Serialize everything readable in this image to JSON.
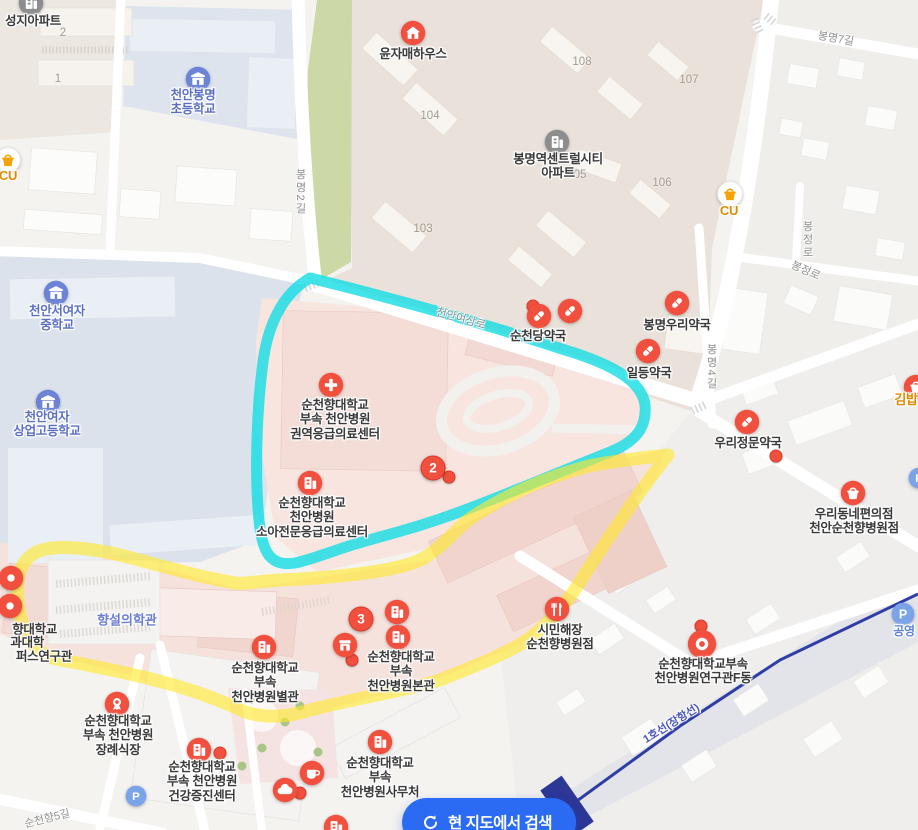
{
  "colors": {
    "poi_red": "#f2503e",
    "poi_red_border": "#d83a27",
    "school_blue": "#6c83d6",
    "apartment_gray": "#8d8d8d",
    "cu_orange": "#f5a300",
    "cu_text": "#e08a00",
    "parking_blue": "#7ba3e8",
    "label_dark": "#3a3a3a",
    "label_school": "#5b6fc4",
    "label_campus": "#6b7ed6",
    "label_road": "#8e8e8e",
    "label_parking": "#5b82d8",
    "railway_text": "#4a55b8",
    "highlight_cyan": "#0ddce4",
    "highlight_yellow": "#ffe92c",
    "button_blue": "#2b6bf3"
  },
  "button": {
    "label": "현 지도에서 검색"
  },
  "road_labels": [
    {
      "text": "봉명2길",
      "x": 300,
      "y": 192,
      "vertical": true
    },
    {
      "text": "봉명7길",
      "x": 836,
      "y": 38,
      "rotate": 10
    },
    {
      "text": "봉명4길",
      "x": 711,
      "y": 367,
      "vertical": true
    },
    {
      "text": "봉정로",
      "x": 807,
      "y": 240,
      "vertical": true
    },
    {
      "text": "봉정로",
      "x": 806,
      "y": 270,
      "rotate": 24
    },
    {
      "text": "천안여상로",
      "x": 461,
      "y": 318,
      "rotate": 16
    },
    {
      "text": "순천향5길",
      "x": 47,
      "y": 818,
      "rotate": -14
    },
    {
      "text": "1호선(장항선)",
      "x": 671,
      "y": 723,
      "rotate": -32,
      "style": "railway"
    }
  ],
  "building_numbers": [
    {
      "text": "2",
      "x": 63,
      "y": 33
    },
    {
      "text": "1",
      "x": 58,
      "y": 79
    },
    {
      "text": "104",
      "x": 430,
      "y": 116
    },
    {
      "text": "103",
      "x": 423,
      "y": 229
    },
    {
      "text": "108",
      "x": 582,
      "y": 62
    },
    {
      "text": "107",
      "x": 689,
      "y": 80
    },
    {
      "text": "106",
      "x": 662,
      "y": 183
    },
    {
      "text": "05",
      "x": 580,
      "y": 175
    }
  ],
  "campus_labels": [
    {
      "text": "향설의학관",
      "x": 127,
      "y": 619
    }
  ],
  "cutoff_labels": [
    {
      "text": "향대학교",
      "x": 57,
      "y": 628
    },
    {
      "text": "과대학",
      "x": 44,
      "y": 641
    },
    {
      "text": "퍼스연구관",
      "x": 72,
      "y": 655
    }
  ],
  "numbered_markers": [
    {
      "number": "2",
      "x": 433,
      "y": 468
    },
    {
      "number": "3",
      "x": 361,
      "y": 619
    }
  ],
  "dots": [
    {
      "x": 449,
      "y": 477
    },
    {
      "x": 533,
      "y": 306
    },
    {
      "x": 776,
      "y": 456
    },
    {
      "x": 352,
      "y": 660
    },
    {
      "x": 701,
      "y": 626
    },
    {
      "x": 220,
      "y": 753
    },
    {
      "x": 300,
      "y": 793
    }
  ],
  "pois": [
    {
      "name": "seongji-apartment",
      "icon": "apartment-icon",
      "x": 31,
      "y": 3,
      "label": {
        "lines": [
          "성지아파트"
        ],
        "x": 33,
        "y": 21
      }
    },
    {
      "name": "cheonan-bongmyeong-elementary",
      "icon": "school-icon",
      "x": 198,
      "y": 79,
      "label": {
        "lines": [
          "천안봉명",
          "초등학교"
        ],
        "x": 193,
        "y": 95,
        "style": "school"
      }
    },
    {
      "name": "cu-bongmyeong-west",
      "icon": "cu-icon",
      "x": 8,
      "y": 160,
      "label": {
        "lines": [
          "CU"
        ],
        "x": 8,
        "y": 176,
        "style": "cu"
      }
    },
    {
      "name": "yunjamae-house",
      "icon": "house-icon",
      "x": 413,
      "y": 33,
      "label": {
        "lines": [
          "윤자매하우스"
        ],
        "x": 413,
        "y": 54
      }
    },
    {
      "name": "bongmyeong-central-city-apt",
      "icon": "apartment-icon",
      "x": 557,
      "y": 142,
      "label": {
        "lines": [
          "봉명역센트럴시티",
          "아파트"
        ],
        "x": 558,
        "y": 159
      }
    },
    {
      "name": "cu-bongmyeong-east",
      "icon": "cu-icon",
      "x": 730,
      "y": 194,
      "label": {
        "lines": [
          "CU"
        ],
        "x": 729,
        "y": 211,
        "style": "cu"
      }
    },
    {
      "name": "cheonan-seo-girls-middle",
      "icon": "school-icon",
      "x": 56,
      "y": 293,
      "label": {
        "lines": [
          "천안서여자",
          "중학교"
        ],
        "x": 57,
        "y": 311,
        "style": "school"
      }
    },
    {
      "name": "cheonan-girls-commercial-high",
      "icon": "school-icon",
      "x": 48,
      "y": 402,
      "label": {
        "lines": [
          "천안여자",
          "상업고등학교"
        ],
        "x": 47,
        "y": 417,
        "style": "school"
      }
    },
    {
      "name": "suncheondang-pharmacy",
      "icon": "pill-icon",
      "x": 539,
      "y": 316,
      "label": {
        "lines": [
          "순천당약국"
        ],
        "x": 538,
        "y": 336
      }
    },
    {
      "name": "pharmacy-unnamed",
      "icon": "pill-icon",
      "x": 570,
      "y": 311
    },
    {
      "name": "bongmyeong-woori-pharmacy",
      "icon": "pill-icon",
      "x": 677,
      "y": 303,
      "label": {
        "lines": [
          "봉명우리약국"
        ],
        "x": 677,
        "y": 325
      }
    },
    {
      "name": "ildeung-pharmacy",
      "icon": "pill-icon",
      "x": 648,
      "y": 351,
      "label": {
        "lines": [
          "일등약국"
        ],
        "x": 649,
        "y": 373
      }
    },
    {
      "name": "woori-jeongmun-pharmacy",
      "icon": "pill-icon",
      "x": 747,
      "y": 422,
      "label": {
        "lines": [
          "우리정문약국"
        ],
        "x": 748,
        "y": 443
      }
    },
    {
      "name": "gimbap-shop",
      "icon": "basket-icon",
      "x": 916,
      "y": 387,
      "label": {
        "lines": [
          "김밥"
        ],
        "x": 906,
        "y": 400,
        "style": "cu"
      }
    },
    {
      "name": "woori-convenience",
      "icon": "basket-icon",
      "x": 853,
      "y": 493,
      "label": {
        "lines": [
          "우리동네편의점",
          "천안순천향병원점"
        ],
        "x": 854,
        "y": 514
      }
    },
    {
      "name": "regional-emergency-center",
      "icon": "hospital-cross-icon",
      "x": 331,
      "y": 385,
      "label": {
        "lines": [
          "순천향대학교",
          "부속 천안병원",
          "권역응급의료센터"
        ],
        "x": 335,
        "y": 405
      }
    },
    {
      "name": "pediatric-emergency-center",
      "icon": "building-icon",
      "x": 310,
      "y": 483,
      "label": {
        "lines": [
          "순천향대학교",
          "천안병원",
          "소아전문응급의료센터"
        ],
        "x": 312,
        "y": 503
      }
    },
    {
      "name": "hospital-annex",
      "icon": "building-icon",
      "x": 264,
      "y": 647,
      "label": {
        "lines": [
          "순천향대학교",
          "부속",
          "천안병원별관"
        ],
        "x": 265,
        "y": 668
      }
    },
    {
      "name": "hospital-main-upper-icon",
      "icon": "building-icon",
      "x": 397,
      "y": 612
    },
    {
      "name": "hospital-main",
      "icon": "building-icon",
      "x": 398,
      "y": 637,
      "label": {
        "lines": [
          "순천향대학교",
          "부속",
          "천안병원본관"
        ],
        "x": 401,
        "y": 657
      }
    },
    {
      "name": "hospital-store",
      "icon": "store-icon",
      "x": 345,
      "y": 645
    },
    {
      "name": "funeral-hall",
      "icon": "funeral-icon",
      "x": 117,
      "y": 704,
      "label": {
        "lines": [
          "순천향대학교",
          "부속 천안병원",
          "장례식장"
        ],
        "x": 118,
        "y": 721
      }
    },
    {
      "name": "health-promotion-center",
      "icon": "building-icon",
      "x": 199,
      "y": 750,
      "label": {
        "lines": [
          "순천향대학교",
          "부속 천안병원",
          "건강증진센터"
        ],
        "x": 202,
        "y": 767
      }
    },
    {
      "name": "hospital-office",
      "icon": "building-icon",
      "x": 380,
      "y": 742,
      "label": {
        "lines": [
          "순천향대학교",
          "부속",
          "천안병원사무처"
        ],
        "x": 380,
        "y": 763
      }
    },
    {
      "name": "simin-haejang",
      "icon": "restaurant-icon",
      "x": 557,
      "y": 609,
      "label": {
        "lines": [
          "시민해장",
          "순천향병원점"
        ],
        "x": 560,
        "y": 630
      }
    },
    {
      "name": "hospital-research-f",
      "icon": "ring-icon",
      "x": 702,
      "y": 644,
      "label": {
        "lines": [
          "순천향대학교부속",
          "천안병원연구관F동"
        ],
        "x": 703,
        "y": 664
      }
    },
    {
      "name": "parking-west",
      "icon": "parking-icon",
      "x": 136,
      "y": 796,
      "size": 22
    },
    {
      "name": "public-parking",
      "icon": "parking-icon",
      "x": 903,
      "y": 614,
      "size": 24,
      "label": {
        "lines": [
          "공영"
        ],
        "x": 904,
        "y": 631,
        "style": "parking"
      }
    },
    {
      "name": "coffee-shop",
      "icon": "coffee-icon",
      "x": 312,
      "y": 773
    },
    {
      "name": "cloud-poi",
      "icon": "cloud-icon",
      "x": 285,
      "y": 790
    },
    {
      "name": "pin-west-1",
      "icon": "dot-pin-icon",
      "x": 11,
      "y": 578
    },
    {
      "name": "pin-west-2",
      "icon": "dot-pin-icon",
      "x": 10,
      "y": 606
    },
    {
      "name": "partial-poi-bottom",
      "icon": "building-icon",
      "x": 336,
      "y": 827
    },
    {
      "name": "parking-east-partial",
      "icon": "parking-icon",
      "x": 919,
      "y": 478,
      "size": 22
    }
  ]
}
